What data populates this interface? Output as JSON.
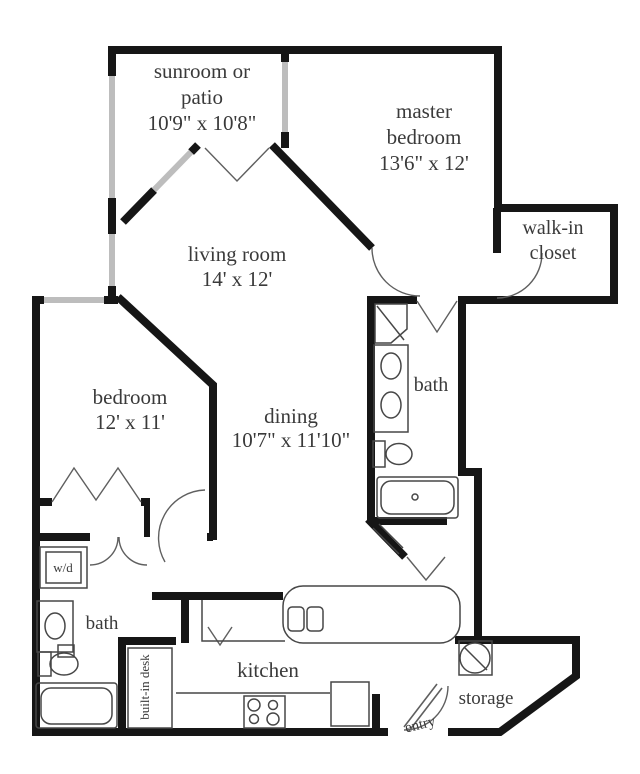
{
  "plan": {
    "sunroom": {
      "line1": "sunroom or",
      "line2": "patio",
      "dims": "10'9\" x 10'8\""
    },
    "master_bedroom": {
      "line1": "master",
      "line2": "bedroom",
      "dims": "13'6\" x 12'"
    },
    "walk_in_closet": {
      "line1": "walk-in",
      "line2": "closet"
    },
    "living_room": {
      "name": "living room",
      "dims": "14' x 12'"
    },
    "bedroom": {
      "name": "bedroom",
      "dims": "12' x 11'"
    },
    "dining": {
      "name": "dining",
      "dims": "10'7\" x 11'10\""
    },
    "master_bath": {
      "name": "bath"
    },
    "hall_bath": {
      "name": "bath"
    },
    "laundry": {
      "name": "w/d"
    },
    "built_in_desk": {
      "name": "built-in desk"
    },
    "kitchen": {
      "name": "kitchen"
    },
    "storage": {
      "name": "storage"
    },
    "entry": {
      "name": "entry"
    }
  },
  "colors": {
    "wall": "#161616",
    "window": "#bdbdbd",
    "door_swing": "#5f5f5f",
    "fixture": "#474747",
    "label_text": "#3a3a3a",
    "background": "#ffffff"
  }
}
